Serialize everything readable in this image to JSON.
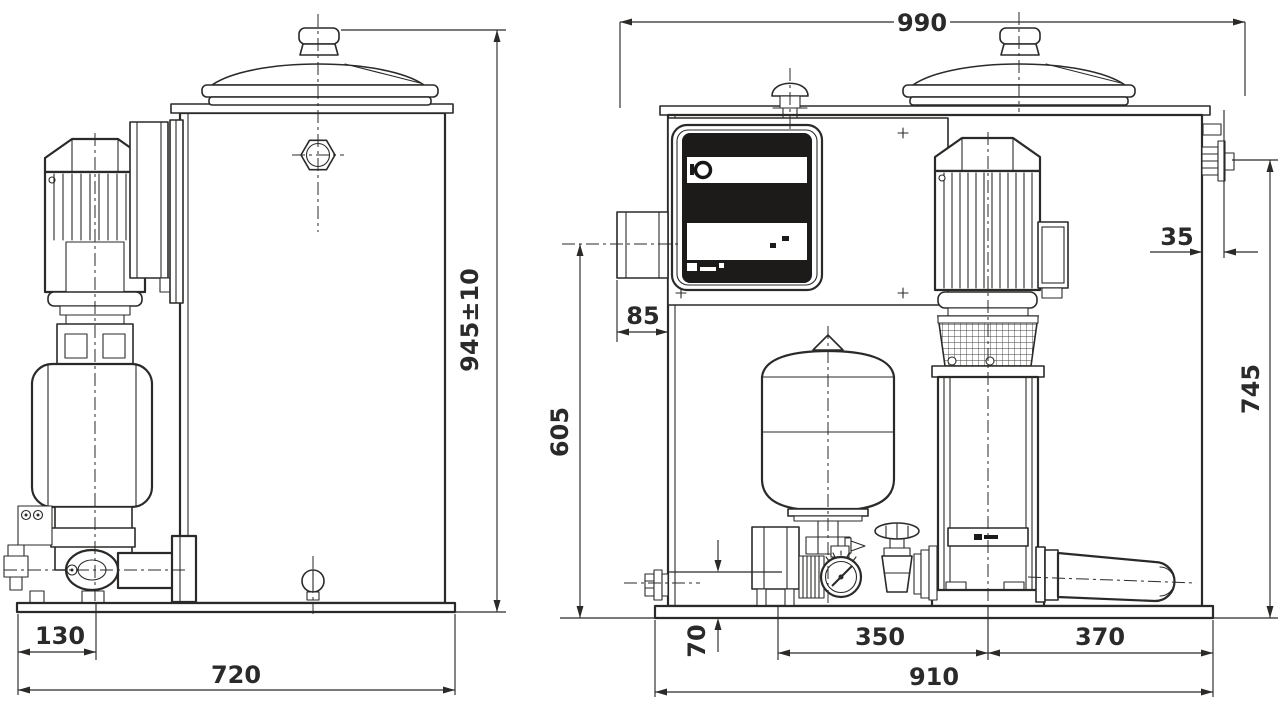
{
  "meta": {
    "document_type": "technical dimensional drawing",
    "subject": "pressure boosting system with tank, pump, diaphragm vessel and control panel",
    "units": "mm",
    "views": [
      "side view",
      "front view"
    ],
    "line_color": "#2b2a28",
    "panel_color": "#1d1b1a",
    "background": "#ffffff"
  },
  "dimensions": {
    "front_overall_width": {
      "value": "990"
    },
    "side_overall_height": {
      "value": "945±10"
    },
    "side_pump_offset": {
      "value": "130"
    },
    "side_base_width": {
      "value": "720"
    },
    "front_conduit_height": {
      "value": "605"
    },
    "front_conduit_depth": {
      "value": "85"
    },
    "front_connection_offset": {
      "value": "35"
    },
    "front_connection_height": {
      "value": "745"
    },
    "front_pipe_centre_height": {
      "value": "70"
    },
    "front_left_span": {
      "value": "350"
    },
    "front_right_span": {
      "value": "370"
    },
    "front_base_width": {
      "value": "910"
    }
  }
}
